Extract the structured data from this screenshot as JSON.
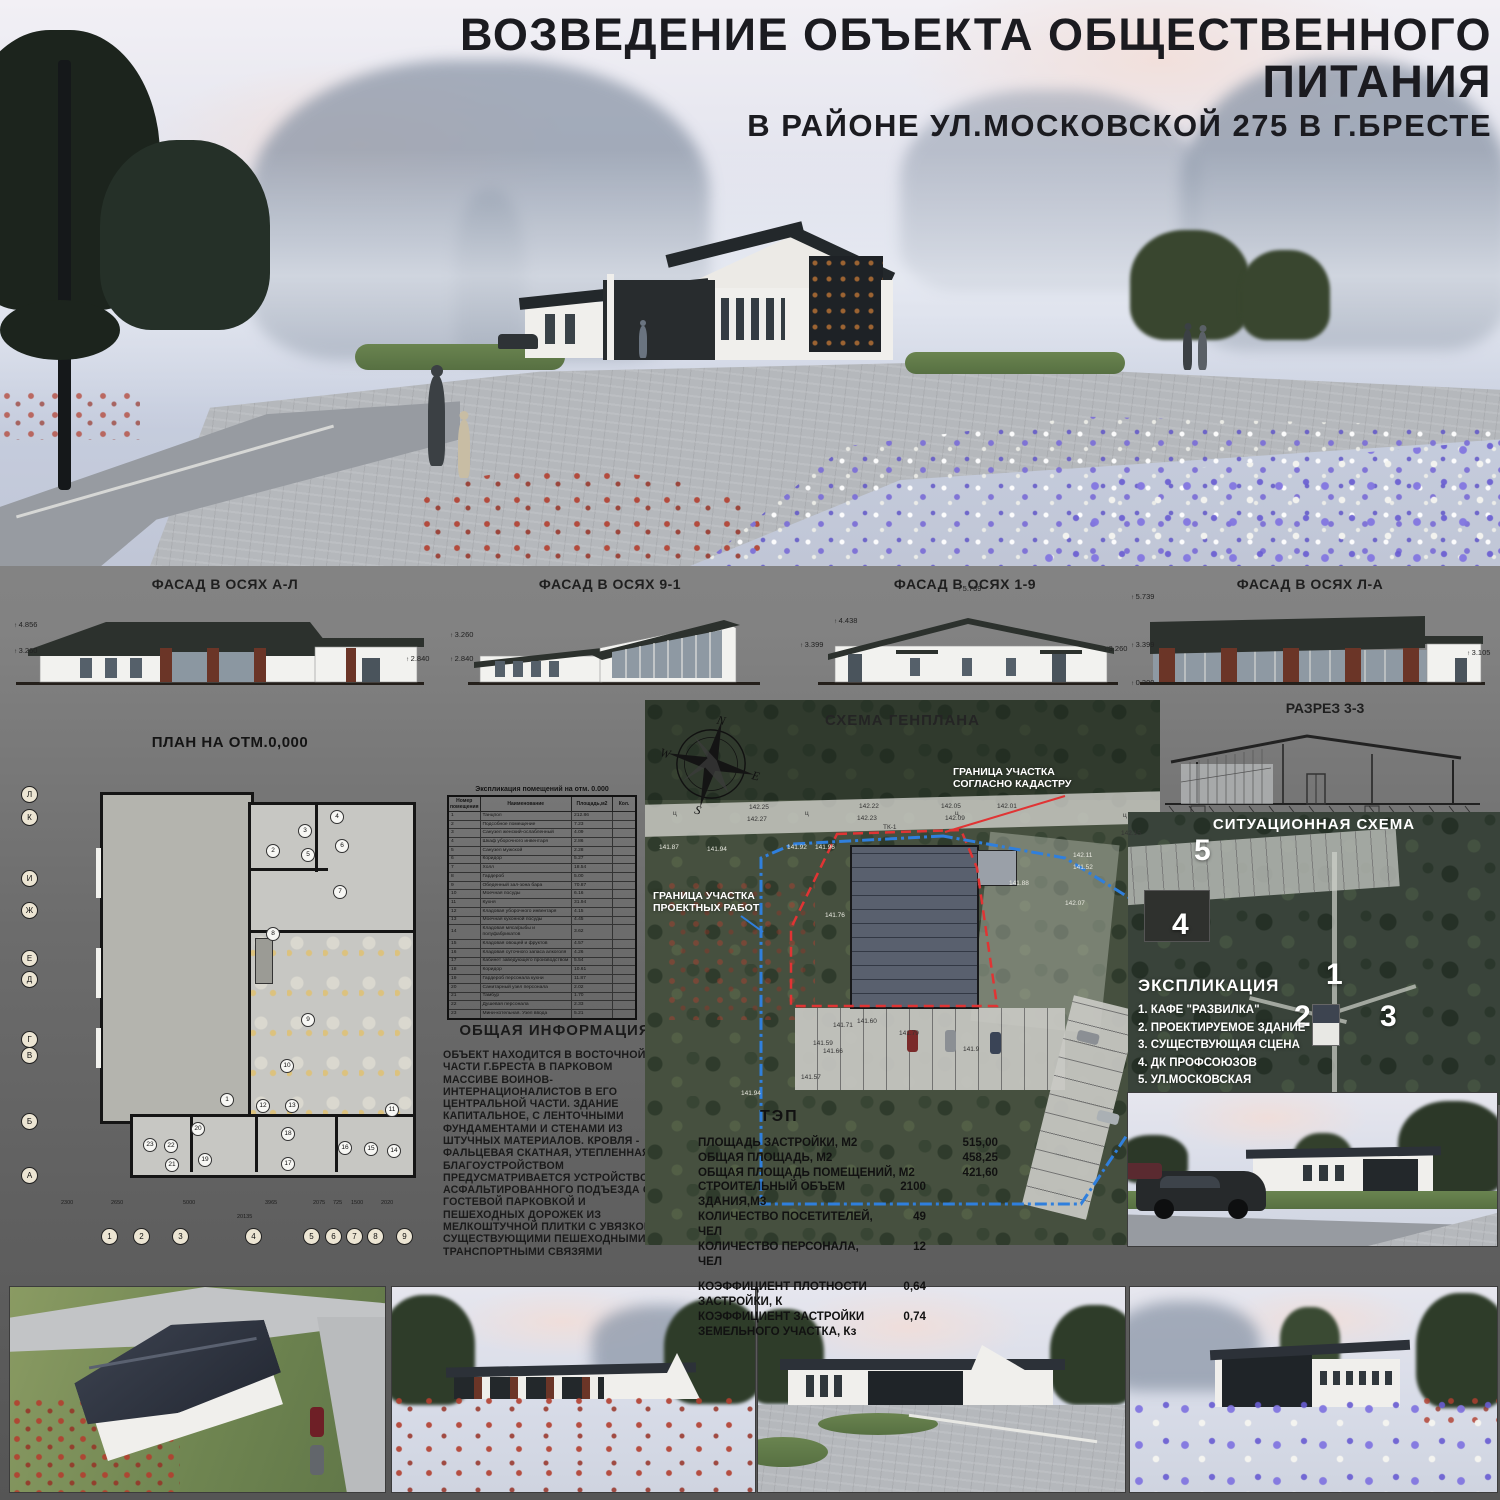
{
  "title": {
    "line1": "ВОЗВЕДЕНИЕ ОБЪЕКТА ОБЩЕСТВЕННОГО ПИТАНИЯ",
    "line2": "В РАЙОНЕ УЛ.МОСКОВСКОЙ 275 В Г.БРЕСТЕ"
  },
  "colors": {
    "roof": "#2c312d",
    "brick": "#6b3527",
    "boundary_red": "#e03434",
    "boundary_blue": "#2f7fdd"
  },
  "facades": [
    {
      "label": "ФАСАД В ОСЯХ А-Л",
      "marks": [
        {
          "t": "4.856",
          "x": 4,
          "y": 44
        },
        {
          "t": "3.260",
          "x": 4,
          "y": 70
        },
        {
          "t": "2.840",
          "x": 396,
          "y": 78
        }
      ]
    },
    {
      "label": "ФАСАД В ОСЯХ 9-1",
      "marks": [
        {
          "t": "3.260",
          "x": 0,
          "y": 54
        },
        {
          "t": "2.840",
          "x": 0,
          "y": 78
        }
      ]
    },
    {
      "label": "ФАСАД В ОСЯХ 1-9",
      "marks": [
        {
          "t": "5.739",
          "x": 158,
          "y": 8
        },
        {
          "t": "4.438",
          "x": 34,
          "y": 40
        },
        {
          "t": "3.399",
          "x": 0,
          "y": 64
        },
        {
          "t": "3.260",
          "x": 304,
          "y": 68
        }
      ]
    },
    {
      "label": "ФАСАД В ОСЯХ Л-А",
      "marks": [
        {
          "t": "5.739",
          "x": 6,
          "y": 16
        },
        {
          "t": "3.399",
          "x": 6,
          "y": 64
        },
        {
          "t": "0.300",
          "x": 6,
          "y": 102
        },
        {
          "t": "3.105",
          "x": 342,
          "y": 72
        }
      ]
    }
  ],
  "plan": {
    "title": "ПЛАН НА ОТМ.0,000",
    "axis_left": [
      {
        "t": "Л",
        "x": 6,
        "y": 58
      },
      {
        "t": "К",
        "x": 6,
        "y": 81
      },
      {
        "t": "И",
        "x": 6,
        "y": 142
      },
      {
        "t": "Ж",
        "x": 6,
        "y": 174
      },
      {
        "t": "Е",
        "x": 6,
        "y": 222
      },
      {
        "t": "Д",
        "x": 6,
        "y": 243
      },
      {
        "t": "Г",
        "x": 6,
        "y": 303
      },
      {
        "t": "В",
        "x": 6,
        "y": 319
      },
      {
        "t": "Б",
        "x": 6,
        "y": 385
      },
      {
        "t": "А",
        "x": 6,
        "y": 439
      }
    ],
    "axis_bottom": [
      {
        "t": "1",
        "x": 86,
        "y": 500
      },
      {
        "t": "2",
        "x": 118,
        "y": 500
      },
      {
        "t": "3",
        "x": 157,
        "y": 500
      },
      {
        "t": "4",
        "x": 230,
        "y": 500
      },
      {
        "t": "5",
        "x": 288,
        "y": 500
      },
      {
        "t": "6",
        "x": 310,
        "y": 500
      },
      {
        "t": "7",
        "x": 331,
        "y": 500
      },
      {
        "t": "8",
        "x": 352,
        "y": 500
      },
      {
        "t": "9",
        "x": 381,
        "y": 500
      }
    ],
    "rooms": [
      {
        "t": "1",
        "x": 205,
        "y": 365
      },
      {
        "t": "2",
        "x": 251,
        "y": 116
      },
      {
        "t": "3",
        "x": 283,
        "y": 96
      },
      {
        "t": "4",
        "x": 315,
        "y": 82
      },
      {
        "t": "5",
        "x": 286,
        "y": 120
      },
      {
        "t": "6",
        "x": 320,
        "y": 111
      },
      {
        "t": "7",
        "x": 318,
        "y": 157
      },
      {
        "t": "8",
        "x": 251,
        "y": 199
      },
      {
        "t": "9",
        "x": 286,
        "y": 285
      },
      {
        "t": "10",
        "x": 265,
        "y": 331
      },
      {
        "t": "11",
        "x": 370,
        "y": 375
      },
      {
        "t": "12",
        "x": 241,
        "y": 371
      },
      {
        "t": "13",
        "x": 270,
        "y": 371
      },
      {
        "t": "14",
        "x": 372,
        "y": 416
      },
      {
        "t": "15",
        "x": 349,
        "y": 414
      },
      {
        "t": "16",
        "x": 323,
        "y": 413
      },
      {
        "t": "17",
        "x": 266,
        "y": 429
      },
      {
        "t": "18",
        "x": 266,
        "y": 399
      },
      {
        "t": "19",
        "x": 183,
        "y": 425
      },
      {
        "t": "20",
        "x": 176,
        "y": 394
      },
      {
        "t": "21",
        "x": 150,
        "y": 430
      },
      {
        "t": "22",
        "x": 149,
        "y": 411
      },
      {
        "t": "23",
        "x": 128,
        "y": 410
      }
    ],
    "dims": [
      {
        "t": "2300",
        "x": 46,
        "y": 472
      },
      {
        "t": "2650",
        "x": 96,
        "y": 472
      },
      {
        "t": "5000",
        "x": 168,
        "y": 472
      },
      {
        "t": "3965",
        "x": 250,
        "y": 472
      },
      {
        "t": "2075",
        "x": 298,
        "y": 472
      },
      {
        "t": "725",
        "x": 318,
        "y": 472
      },
      {
        "t": "1500",
        "x": 336,
        "y": 472
      },
      {
        "t": "2020",
        "x": 366,
        "y": 472
      },
      {
        "t": "20135",
        "x": 222,
        "y": 486
      }
    ]
  },
  "expl_table": {
    "caption": "Экспликация помещений на отм. 0.000",
    "columns": [
      "Номер помещения",
      "Наименование",
      "Площадь,м2",
      "Кол."
    ],
    "rows": [
      {
        "n": "1",
        "name": "Танцпол",
        "area": "212.86",
        "kol": ""
      },
      {
        "n": "2",
        "name": "Подсобное помещение",
        "area": "7.23",
        "kol": ""
      },
      {
        "n": "3",
        "name": "Санузел женский-ослабленный",
        "area": "4.09",
        "kol": ""
      },
      {
        "n": "4",
        "name": "Шкаф уборочного инвентаря",
        "area": "2.86",
        "kol": ""
      },
      {
        "n": "5",
        "name": "Санузел мужской",
        "area": "2.28",
        "kol": ""
      },
      {
        "n": "6",
        "name": "Коридор",
        "area": "5.27",
        "kol": ""
      },
      {
        "n": "7",
        "name": "Холл",
        "area": "18.54",
        "kol": ""
      },
      {
        "n": "8",
        "name": "Гардероб",
        "area": "5.00",
        "kol": ""
      },
      {
        "n": "9",
        "name": "Обеденный зал-зона бара",
        "area": "70.87",
        "kol": ""
      },
      {
        "n": "10",
        "name": "Моечная посуды",
        "area": "6.16",
        "kol": ""
      },
      {
        "n": "11",
        "name": "Кухня",
        "area": "31.94",
        "kol": ""
      },
      {
        "n": "12",
        "name": "Кладовая уборочного инвентаря",
        "area": "4.15",
        "kol": ""
      },
      {
        "n": "13",
        "name": "Моечная кухонной посуды",
        "area": "4.45",
        "kol": ""
      },
      {
        "n": "14",
        "name": "Кладовая мяса/рыбы и полуфабрикатов",
        "area": "3.62",
        "kol": ""
      },
      {
        "n": "15",
        "name": "Кладовая овощей и фруктов",
        "area": "4.57",
        "kol": ""
      },
      {
        "n": "16",
        "name": "Кладовая суточного запаса алкоголя",
        "area": "4.26",
        "kol": ""
      },
      {
        "n": "17",
        "name": "Кабинет заведующего производством",
        "area": "5.54",
        "kol": ""
      },
      {
        "n": "18",
        "name": "Коридор",
        "area": "10.61",
        "kol": ""
      },
      {
        "n": "19",
        "name": "Гардероб персонала кухни",
        "area": "11.87",
        "kol": ""
      },
      {
        "n": "20",
        "name": "Санитарный узел персонала",
        "area": "2.02",
        "kol": ""
      },
      {
        "n": "21",
        "name": "Тамбур",
        "area": "1.70",
        "kol": ""
      },
      {
        "n": "22",
        "name": "Душевая персонала",
        "area": "2.33",
        "kol": ""
      },
      {
        "n": "23",
        "name": "Мини-котельная. Узел ввода",
        "area": "5.21",
        "kol": ""
      }
    ]
  },
  "general_info": {
    "title": "ОБЩАЯ ИНФОРМАЦИЯ",
    "text": "ОБЪЕКТ НАХОДИТСЯ В ВОСТОЧНОЙ ЧАСТИ Г.БРЕСТА В ПАРКОВОМ МАССИВЕ ВОИНОВ-ИНТЕРНАЦИОНАЛИСТОВ В ЕГО ЦЕНТРАЛЬНОЙ ЧАСТИ. ЗДАНИЕ КАПИТАЛЬНОЕ, С ЛЕНТОЧНЫМИ ФУНДАМЕНТАМИ И СТЕНАМИ ИЗ ШТУЧНЫХ МАТЕРИАЛОВ. КРОВЛЯ - ФАЛЬЦЕВАЯ СКАТНАЯ, УТЕПЛЕННАЯ. БЛАГОУСТРОЙСТВОМ ПРЕДУСМАТРИВАЕТСЯ УСТРОЙСТВО АСФАЛЬТИРОВАННОГО ПОДЪЕЗДА С ГОСТЕВОЙ ПАРКОВКОЙ И ПЕШЕХОДНЫХ ДОРОЖЕК ИЗ МЕЛКОШТУЧНОЙ ПЛИТКИ С УВЯЗКОЙ С СУЩЕСТВУЮЩИМИ ПЕШЕХОДНЫМИ И ТРАНСПОРТНЫМИ СВЯЗЯМИ"
  },
  "genplan": {
    "title": "СХЕМА ГЕНПЛАНА",
    "boundary_cadastre": "ГРАНИЦА УЧАСТКА\nСОГЛАСНО КАДАСТРУ",
    "boundary_project": "ГРАНИЦА УЧАСТКА\nПРОЕКТНЫХ РАБОТ",
    "compass": {
      "n": "N",
      "w": "W",
      "e": "E",
      "s": "S"
    },
    "spots": [
      {
        "t": "142.25",
        "x": 104,
        "y": 104,
        "c": "#333"
      },
      {
        "t": "142.27",
        "x": 102,
        "y": 116,
        "c": "#333"
      },
      {
        "t": "142.22",
        "x": 214,
        "y": 103,
        "c": "#333"
      },
      {
        "t": "142.23",
        "x": 212,
        "y": 115,
        "c": "#333"
      },
      {
        "t": "142.05",
        "x": 296,
        "y": 103,
        "c": "#333"
      },
      {
        "t": "142.09",
        "x": 300,
        "y": 115,
        "c": "#333"
      },
      {
        "t": "142.01",
        "x": 352,
        "y": 103,
        "c": "#333"
      },
      {
        "t": "142.15",
        "x": 476,
        "y": 130,
        "c": "#333"
      },
      {
        "t": "ц",
        "x": 28,
        "y": 110,
        "c": "#333"
      },
      {
        "t": "ц",
        "x": 160,
        "y": 110,
        "c": "#333"
      },
      {
        "t": "ц",
        "x": 310,
        "y": 110,
        "c": "#333"
      },
      {
        "t": "ц",
        "x": 478,
        "y": 112,
        "c": "#333"
      },
      {
        "t": "ТК-1",
        "x": 238,
        "y": 124,
        "c": "#333"
      },
      {
        "t": "141.92",
        "x": 142,
        "y": 144
      },
      {
        "t": "141.96",
        "x": 170,
        "y": 144
      },
      {
        "t": "141.94",
        "x": 62,
        "y": 146
      },
      {
        "t": "141.87",
        "x": 14,
        "y": 144
      },
      {
        "t": "141.76",
        "x": 180,
        "y": 212
      },
      {
        "t": "141.88",
        "x": 364,
        "y": 180
      },
      {
        "t": "142.11",
        "x": 428,
        "y": 152
      },
      {
        "t": "141.52",
        "x": 428,
        "y": 164
      },
      {
        "t": "142.07",
        "x": 420,
        "y": 200
      },
      {
        "t": "141.71",
        "x": 188,
        "y": 322,
        "c": "#333"
      },
      {
        "t": "141.60",
        "x": 212,
        "y": 318,
        "c": "#333"
      },
      {
        "t": "141.79",
        "x": 254,
        "y": 330,
        "c": "#333"
      },
      {
        "t": "141.59",
        "x": 168,
        "y": 340,
        "c": "#333"
      },
      {
        "t": "141.66",
        "x": 178,
        "y": 348,
        "c": "#333"
      },
      {
        "t": "141.57",
        "x": 156,
        "y": 374,
        "c": "#333"
      },
      {
        "t": "141.9",
        "x": 318,
        "y": 346,
        "c": "#333"
      },
      {
        "t": "141.94",
        "x": 96,
        "y": 390
      }
    ]
  },
  "tep": {
    "title": "ТЭП",
    "rows_area": [
      {
        "label": "ПЛОЩАДЬ ЗАСТРОЙКИ, М2",
        "value": "515,00"
      },
      {
        "label": "ОБЩАЯ ПЛОЩАДЬ, М2",
        "value": "458,25"
      },
      {
        "label": "ОБЩАЯ ПЛОЩАДЬ ПОМЕЩЕНИЙ, М2",
        "value": "421,60"
      }
    ],
    "rows_count": [
      {
        "label": "СТРОИТЕЛЬНЫЙ ОБЪЕМ ЗДАНИЯ,М3",
        "value": "2100"
      },
      {
        "label": "КОЛИЧЕСТВО ПОСЕТИТЕЛЕЙ, ЧЕЛ",
        "value": "49"
      },
      {
        "label": "КОЛИЧЕСТВО ПЕРСОНАЛА, ЧЕЛ",
        "value": "12"
      }
    ],
    "rows_coef": [
      {
        "label": "КОЭФФИЦИЕНТ ПЛОТНОСТИ ЗАСТРОЙКИ, К",
        "value": "0,64"
      },
      {
        "label": "КОЭФФИЦИЕНТ ЗАСТРОЙКИ ЗЕМЕЛЬНОГО УЧАСТКА, Кз",
        "value": "0,74"
      }
    ]
  },
  "section": {
    "title": "РАЗРЕЗ 3-3",
    "axis_a": "1",
    "axis_b": "9"
  },
  "situation": {
    "title": "СИТУАЦИОННАЯ СХЕМА",
    "markers": [
      {
        "t": "5",
        "x": 66,
        "y": 22
      },
      {
        "t": "4",
        "x": 44,
        "y": 96
      },
      {
        "t": "1",
        "x": 198,
        "y": 146
      },
      {
        "t": "2",
        "x": 166,
        "y": 188
      },
      {
        "t": "3",
        "x": 252,
        "y": 188
      }
    ]
  },
  "expl_list": {
    "title": "ЭКСПЛИКАЦИЯ",
    "items": [
      "1. КАФЕ \"РАЗВИЛКА\"",
      "2. ПРОЕКТИРУЕМОЕ ЗДАНИЕ",
      "3. СУЩЕСТВУЮЩАЯ СЦЕНА",
      "4. ДК ПРОФСОЮЗОВ",
      "5. УЛ.МОСКОВСКАЯ"
    ]
  }
}
